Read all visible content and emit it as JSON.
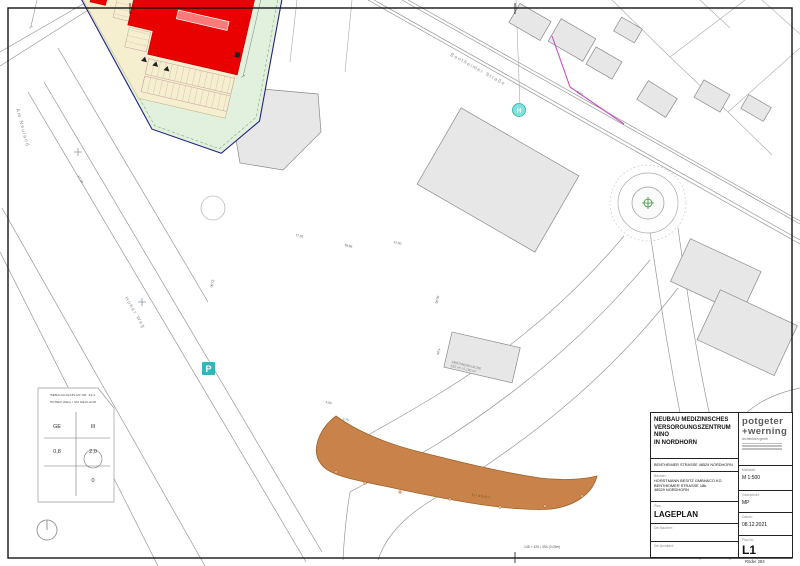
{
  "sheet": {
    "bottom_note": "145 + 420 / 394 (0,05m)",
    "stamp": "Röder 293"
  },
  "map": {
    "street_labels": {
      "bentheimer": "Bentheimer Straße",
      "hoher_weg": "Hoher Weg",
      "am_neuland": "Am Neuland"
    },
    "area_labels": {
      "abstand1": "ABSTANDSFLÄCHE",
      "abstand2": "532 m² / 5.190 m²",
      "graben": "Graben"
    },
    "markers": {
      "parking": "P",
      "bus_stop": "H"
    },
    "dimensions": [
      "58,86",
      "17,05",
      "30,00",
      "21,00",
      "4,00",
      "2,75",
      "5,00",
      "12,50",
      "57,28",
      "6,00"
    ]
  },
  "legend": {
    "line1": "BEBAUUNGSPLAN NR. 62.2",
    "line2": "HOHER WEG / AM NEULAND",
    "use": "GE",
    "storeys": "III",
    "grz": "0,8",
    "gfz": "2,0",
    "extra": "0"
  },
  "title_block": {
    "project_lines": [
      "NEUBAU MEDIZINISCHES",
      "VERSORGUNGSZENTRUM NINO",
      "IN NORDHORN"
    ],
    "address": "BENTHEIMER STRASSE 48529 NORDHORN",
    "client_label": "Bauherr:",
    "client_lines": [
      "HORSTMANN BESITZ GMBH&CO.KG",
      "BENTHEIMER STRASSE 18b",
      "48529 NORDHORN"
    ],
    "plan_label": "Plan:",
    "plan_name": "LAGEPLAN",
    "sig_client_label": "Der Bauherr:",
    "sig_architect_label": "Der Architekt:",
    "scale_label": "Maßstab:",
    "scale_value": "M 1:500",
    "drawn_label": "Gezeichnet:",
    "drawn_value": "MP",
    "date_label": "Datum:",
    "date_value": "08.12.2021",
    "plan_no_label": "Plan Nr.:",
    "plan_no_value": "L1",
    "logo_line1": "potgeter",
    "logo_line2": "+werning",
    "logo_sub": "architekten gmbh"
  }
}
